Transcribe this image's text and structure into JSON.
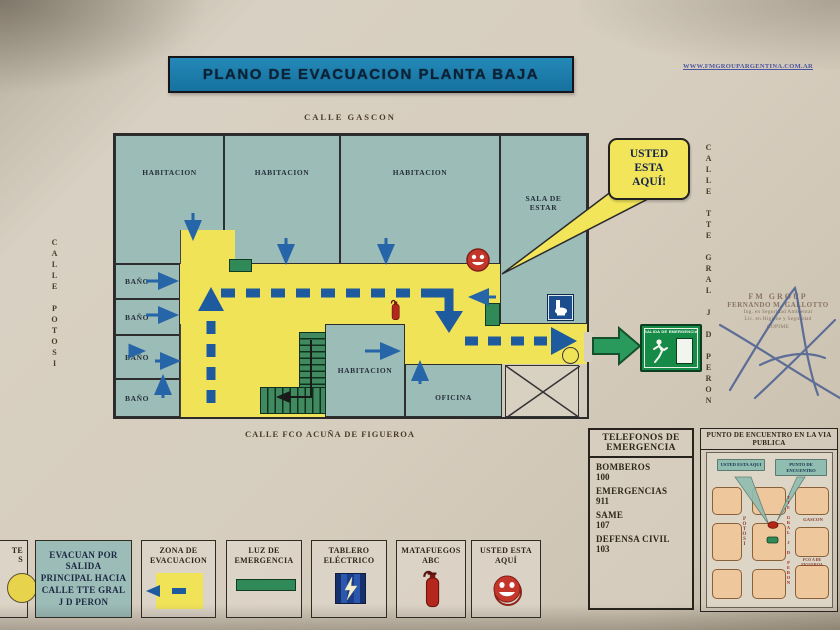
{
  "header": {
    "title": "PLANO DE EVACUACION PLANTA BAJA",
    "website": "WWW.FMGROUPARGENTINA.COM.AR"
  },
  "streets": {
    "top": "CALLE GASCON",
    "left": "CALLE POTOSI",
    "right": "CALLE TTE GRAL J D PERON",
    "bottom": "CALLE FCO ACUÑA DE FIGUEROA"
  },
  "rooms": {
    "habitacion_1": "HABITACION",
    "habitacion_2": "HABITACION",
    "habitacion_3": "HABITACION",
    "sala_de_estar": "SALA DE ESTAR",
    "bano_1": "BAÑO",
    "bano_2": "BAÑO",
    "bano_3": "BAÑO",
    "bano_4": "BAÑO",
    "habitacion_4": "HABITACION",
    "oficina": "OFICINA"
  },
  "callout": {
    "you_are_here": "USTED ESTA AQUÍ!"
  },
  "exit_sign": {
    "label": "SALIDA DE EMERGENCIA"
  },
  "stamp": {
    "company": "FM GROUP",
    "name": "FERNANDO M. GALLOTTO",
    "line1": "Ing. en Seguridad Ambiental",
    "line2": "Lic. en Higiene y Seguridad",
    "line3": "COPIME"
  },
  "emergency_phones": {
    "title": "TELEFONOS DE EMERGENCIA",
    "entries": [
      {
        "label": "BOMBEROS",
        "number": "100"
      },
      {
        "label": "EMERGENCIAS",
        "number": "911"
      },
      {
        "label": "SAME",
        "number": "107"
      },
      {
        "label": "DEFENSA CIVIL",
        "number": "103"
      }
    ]
  },
  "meeting_point": {
    "title": "PUNTO DE ENCUENTRO EN LA VIA PUBLICA",
    "you_are_here": "USTED ESTA AQUI",
    "meeting_label": "PUNTO DE ENCUENTRO",
    "streets": {
      "potosi": "POTOSI",
      "peron": "TTE GRAL J D PERON",
      "gascon": "GASCON",
      "figueroa": "FCO A DE FIGUEROA"
    }
  },
  "legend": {
    "cutoff_fragment_1": "TE",
    "cutoff_fragment_2": "S",
    "items": [
      {
        "label": "EVACUAN POR SALIDA PRINCIPAL HACIA CALLE TTE GRAL J D PERON"
      },
      {
        "label": "ZONA DE EVACUACION"
      },
      {
        "label": "LUZ DE EMERGENCIA"
      },
      {
        "label": "TABLERO ELÉCTRICO"
      },
      {
        "label": "MATAFUEGOS ABC"
      },
      {
        "label": "USTED ESTA AQUÍ"
      }
    ]
  },
  "colors": {
    "banner_blue": "#16719e",
    "room_teal": "#9cbcb8",
    "evacuation_yellow": "#f0e358",
    "route_blue": "#1d5a9e",
    "exit_green": "#168a47",
    "alert_red": "#c0392b"
  }
}
